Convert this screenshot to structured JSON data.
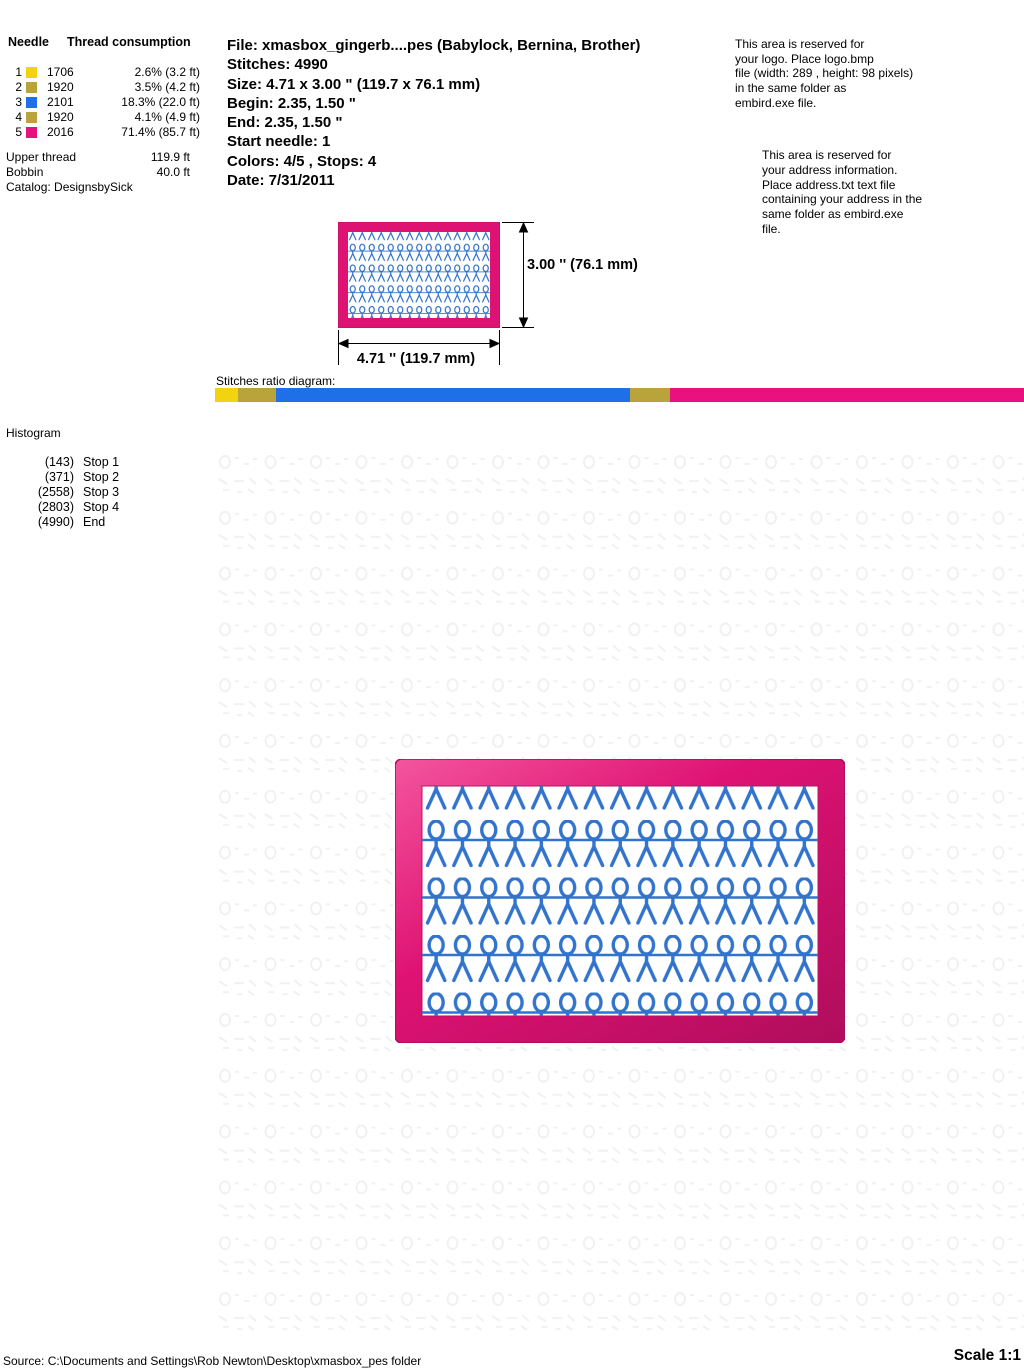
{
  "colors": {
    "yellow": "#F2D30F",
    "olive": "#B9A33B",
    "blue": "#1E6FE8",
    "magenta": "#E8117E",
    "pink": "#DE1273",
    "pinklight": "#F4559E",
    "pinkdark": "#B00D5C",
    "stitch": "#3273CC",
    "watermark": "#EFEFEF"
  },
  "thread_table": {
    "header_needle": "Needle",
    "header_consumption": "Thread consumption",
    "rows": [
      {
        "needle": "1",
        "color": "#F2D30F",
        "code": "1706",
        "consumption": "2.6% (3.2 ft)"
      },
      {
        "needle": "2",
        "color": "#B9A33B",
        "code": "1920",
        "consumption": "3.5% (4.2 ft)"
      },
      {
        "needle": "3",
        "color": "#1E6FE8",
        "code": "2101",
        "consumption": "18.3% (22.0 ft)"
      },
      {
        "needle": "4",
        "color": "#B9A33B",
        "code": "1920",
        "consumption": "4.1% (4.9 ft)"
      },
      {
        "needle": "5",
        "color": "#E8117E",
        "code": "2016",
        "consumption": "71.4% (85.7 ft)"
      }
    ],
    "upper_thread_label": "Upper thread",
    "upper_thread_value": "119.9 ft",
    "bobbin_label": "Bobbin",
    "bobbin_value": "40.0 ft",
    "catalog": "Catalog: DesignsbySick"
  },
  "file_info": {
    "file": "File: xmasbox_gingerb....pes  (Babylock, Bernina, Brother)",
    "stitches": "Stitches: 4990",
    "size": "Size: 4.71 x 3.00 \" (119.7 x 76.1 mm)",
    "begin": "Begin: 2.35, 1.50 \"",
    "end": "End: 2.35, 1.50 \"",
    "start_needle": "Start needle: 1",
    "colors": "Colors: 4/5 , Stops: 4",
    "date": "Date: 7/31/2011"
  },
  "logo_note": {
    "lines": [
      "This area is reserved for",
      "your logo. Place logo.bmp",
      "file (width: 289 , height: 98 pixels)",
      "in the same folder as",
      "embird.exe file."
    ]
  },
  "address_note": {
    "lines": [
      "This area is reserved for",
      "your address information.",
      "Place address.txt text file",
      "containing your address in the",
      "same folder as embird.exe",
      "file."
    ]
  },
  "preview": {
    "height_label": "3.00 '' (76.1 mm)",
    "width_label": "4.71 '' (119.7 mm)"
  },
  "ratio_diagram": {
    "label": "Stitches ratio diagram:",
    "segments": [
      {
        "color": "#F2D30F",
        "percent": 2.9
      },
      {
        "color": "#B9A33B",
        "percent": 4.6
      },
      {
        "color": "#1E6FE8",
        "percent": 43.8
      },
      {
        "color": "#B9A33B",
        "percent": 4.9
      },
      {
        "color": "#E8117E",
        "percent": 43.8
      }
    ]
  },
  "histogram": {
    "title": "Histogram",
    "entries": [
      {
        "count": "(143)",
        "label": "Stop 1"
      },
      {
        "count": "(371)",
        "label": "Stop 2"
      },
      {
        "count": "(2558)",
        "label": "Stop 3"
      },
      {
        "count": "(2803)",
        "label": "Stop 4"
      },
      {
        "count": "(4990)",
        "label": "End"
      }
    ]
  },
  "footer": {
    "source": "Source: C:\\Documents and Settings\\Rob Newton\\Desktop\\xmasbox_pes folder",
    "scale": "Scale 1:1"
  }
}
